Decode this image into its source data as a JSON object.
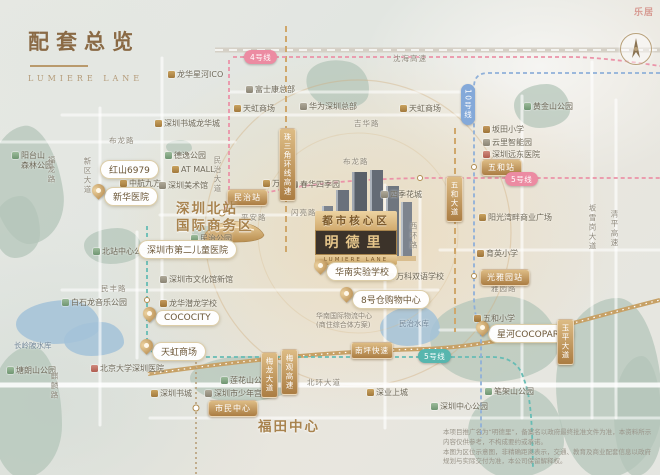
{
  "header": {
    "title": "配套总览",
    "subtitle": "LUMIERE LANE"
  },
  "watermark": "乐居",
  "project": {
    "banner": "都市核心区",
    "name": "明德里",
    "name_en": "LUMIERE LANE"
  },
  "accent_colors": {
    "gold": "#b08c50",
    "pink_line": "#ec8ba2",
    "teal_line": "#57b6ae",
    "blue_line": "#84a9d9",
    "park_green": "#b3c5b8",
    "water_blue": "#a3c2d8"
  },
  "districts": [
    {
      "text": "深圳北站\n国际商务区",
      "x": 176,
      "y": 201
    },
    {
      "text": "福田中心",
      "x": 258,
      "y": 419
    }
  ],
  "labels": [
    {
      "text": "龙华星河ICO",
      "x": 168,
      "y": 70,
      "icon": "mall"
    },
    {
      "text": "富士康总部",
      "x": 246,
      "y": 85,
      "icon": "landmark"
    },
    {
      "text": "天虹商场",
      "x": 234,
      "y": 104,
      "icon": "mall"
    },
    {
      "text": "华为深圳总部",
      "x": 300,
      "y": 102,
      "icon": "landmark"
    },
    {
      "text": "天虹商场",
      "x": 400,
      "y": 104,
      "icon": "mall"
    },
    {
      "text": "深圳书城龙华城",
      "x": 155,
      "y": 119,
      "icon": "mall"
    },
    {
      "text": "德逸公园",
      "x": 165,
      "y": 151,
      "icon": "park"
    },
    {
      "text": "AT MALL",
      "x": 172,
      "y": 165,
      "icon": "mall"
    },
    {
      "text": "中航九方",
      "x": 120,
      "y": 179,
      "icon": "mall"
    },
    {
      "text": "深圳美术馆",
      "x": 159,
      "y": 181,
      "icon": "landmark"
    },
    {
      "text": "万众城",
      "x": 263,
      "y": 179,
      "icon": "mall"
    },
    {
      "text": "阳台山\n森林公园",
      "x": 12,
      "y": 151,
      "icon": "park"
    },
    {
      "text": "民治公园",
      "x": 191,
      "y": 234,
      "icon": "park"
    },
    {
      "text": "北站中心公园",
      "x": 93,
      "y": 247,
      "icon": "park"
    },
    {
      "text": "深圳市文化馆新馆",
      "x": 160,
      "y": 275,
      "icon": "landmark"
    },
    {
      "text": "白石龙音乐公园",
      "x": 62,
      "y": 298,
      "icon": "park"
    },
    {
      "text": "龙华潜龙学校",
      "x": 160,
      "y": 299,
      "icon": "school"
    },
    {
      "text": "坂田小学",
      "x": 483,
      "y": 125,
      "icon": "school"
    },
    {
      "text": "云里智能园",
      "x": 483,
      "y": 138,
      "icon": "landmark"
    },
    {
      "text": "深圳远东医院",
      "x": 483,
      "y": 150,
      "icon": "hospital"
    },
    {
      "text": "阳光湾畔商业广场",
      "x": 479,
      "y": 213,
      "icon": "mall"
    },
    {
      "text": "育英小学",
      "x": 477,
      "y": 249,
      "icon": "school"
    },
    {
      "text": "五和小学",
      "x": 474,
      "y": 314,
      "icon": "school"
    },
    {
      "text": "万科双语学校",
      "x": 387,
      "y": 272,
      "icon": "school"
    },
    {
      "text": "春华四季园",
      "x": 291,
      "y": 180,
      "icon": "landmark"
    },
    {
      "text": "四季花城",
      "x": 381,
      "y": 190,
      "icon": "landmark"
    },
    {
      "text": "北京大学深圳医院",
      "x": 91,
      "y": 364,
      "icon": "hospital"
    },
    {
      "text": "深圳书城",
      "x": 151,
      "y": 389,
      "icon": "mall"
    },
    {
      "text": "塘朗山公园",
      "x": 7,
      "y": 366,
      "icon": "park"
    },
    {
      "text": "莲花山公园",
      "x": 221,
      "y": 376,
      "icon": "park"
    },
    {
      "text": "深圳市少年宫",
      "x": 205,
      "y": 389,
      "icon": "landmark"
    },
    {
      "text": "深业上城",
      "x": 367,
      "y": 388,
      "icon": "mall"
    },
    {
      "text": "笔架山公园",
      "x": 485,
      "y": 387,
      "icon": "park"
    },
    {
      "text": "深圳中心公园",
      "x": 431,
      "y": 402,
      "icon": "park"
    },
    {
      "text": "黄金山公园",
      "x": 524,
      "y": 102,
      "icon": "park"
    }
  ],
  "labels_plain": [
    {
      "text": "民治水库",
      "x": 399,
      "y": 319,
      "cls": "water"
    },
    {
      "text": "长岭陂水库",
      "x": 14,
      "y": 341,
      "cls": "water"
    },
    {
      "text": "华南国际物流中心\n(商住综合体方案)",
      "x": 316,
      "y": 312,
      "cls": "tiny"
    }
  ],
  "roads": [
    {
      "text": "沈海高速",
      "x": 393,
      "y": 53
    },
    {
      "text": "吉华路",
      "x": 354,
      "y": 118
    },
    {
      "text": "布龙路",
      "x": 109,
      "y": 135
    },
    {
      "text": "布龙路",
      "x": 343,
      "y": 156
    },
    {
      "text": "新区大道",
      "x": 82,
      "y": 157,
      "v": true
    },
    {
      "text": "福龙路",
      "x": 46,
      "y": 156,
      "v": true
    },
    {
      "text": "民治大道",
      "x": 212,
      "y": 156,
      "v": true
    },
    {
      "text": "平安路",
      "x": 241,
      "y": 212
    },
    {
      "text": "民丰路",
      "x": 101,
      "y": 283
    },
    {
      "text": "闪亮路",
      "x": 291,
      "y": 207
    },
    {
      "text": "西环路",
      "x": 408,
      "y": 222,
      "v": true
    },
    {
      "text": "坂雪岗大道",
      "x": 587,
      "y": 204,
      "v": true
    },
    {
      "text": "清平高速",
      "x": 609,
      "y": 210,
      "v": true
    },
    {
      "text": "北环大道",
      "x": 307,
      "y": 377
    },
    {
      "text": "雅园路",
      "x": 491,
      "y": 283
    },
    {
      "text": "麒麟路",
      "x": 49,
      "y": 372,
      "v": true
    }
  ],
  "pills": [
    {
      "text": "红山6979",
      "x": 100,
      "y": 160
    },
    {
      "text": "新华医院",
      "x": 104,
      "y": 187,
      "pin": true
    },
    {
      "text": "深圳市第二儿童医院",
      "x": 138,
      "y": 240
    },
    {
      "text": "COCOCITY",
      "x": 155,
      "y": 310,
      "pin": true
    },
    {
      "text": "天虹商场",
      "x": 152,
      "y": 342,
      "pin": true
    },
    {
      "text": "华南实验学校",
      "x": 326,
      "y": 262,
      "pin": true
    },
    {
      "text": "8号仓购物中心",
      "x": 352,
      "y": 290,
      "pin": true
    },
    {
      "text": "星河COCOPARK",
      "x": 488,
      "y": 324,
      "pin": true
    }
  ],
  "station_badges": [
    {
      "text": "民治站",
      "x": 227,
      "y": 189
    },
    {
      "text": "五和站",
      "x": 481,
      "y": 159
    },
    {
      "text": "光雅园站",
      "x": 480,
      "y": 269
    },
    {
      "text": "市民中心",
      "x": 208,
      "y": 400
    }
  ],
  "road_badges": [
    {
      "text": "珠三角环线高速",
      "x": 279,
      "y": 128,
      "v": true
    },
    {
      "text": "五和大道",
      "x": 446,
      "y": 176,
      "v": true
    },
    {
      "text": "南坪快速",
      "x": 351,
      "y": 342
    },
    {
      "text": "梅龙大道",
      "x": 261,
      "y": 352,
      "v": true
    },
    {
      "text": "梅观高速",
      "x": 281,
      "y": 349,
      "v": true
    },
    {
      "text": "玉平大道",
      "x": 557,
      "y": 319,
      "v": true
    }
  ],
  "line_badges": [
    {
      "text": "4号线",
      "x": 244,
      "y": 50,
      "color": "pink"
    },
    {
      "text": "5号线",
      "x": 505,
      "y": 172,
      "color": "pink"
    },
    {
      "text": "10号线",
      "x": 461,
      "y": 84,
      "color": "blue",
      "v": true
    },
    {
      "text": "5号线",
      "x": 418,
      "y": 349,
      "color": "teal"
    }
  ],
  "disclaimer": {
    "line1": "本项目推广名为“明德里”，备案名以政府最终批准文件为准，本资料所示内容仅供参考，不构成要约或承诺。",
    "line2": "本图为区位示意图，非精确距离表示，交通、教育及商业配套信息以政府规划与实际交付为准，本公司保留解释权。"
  }
}
